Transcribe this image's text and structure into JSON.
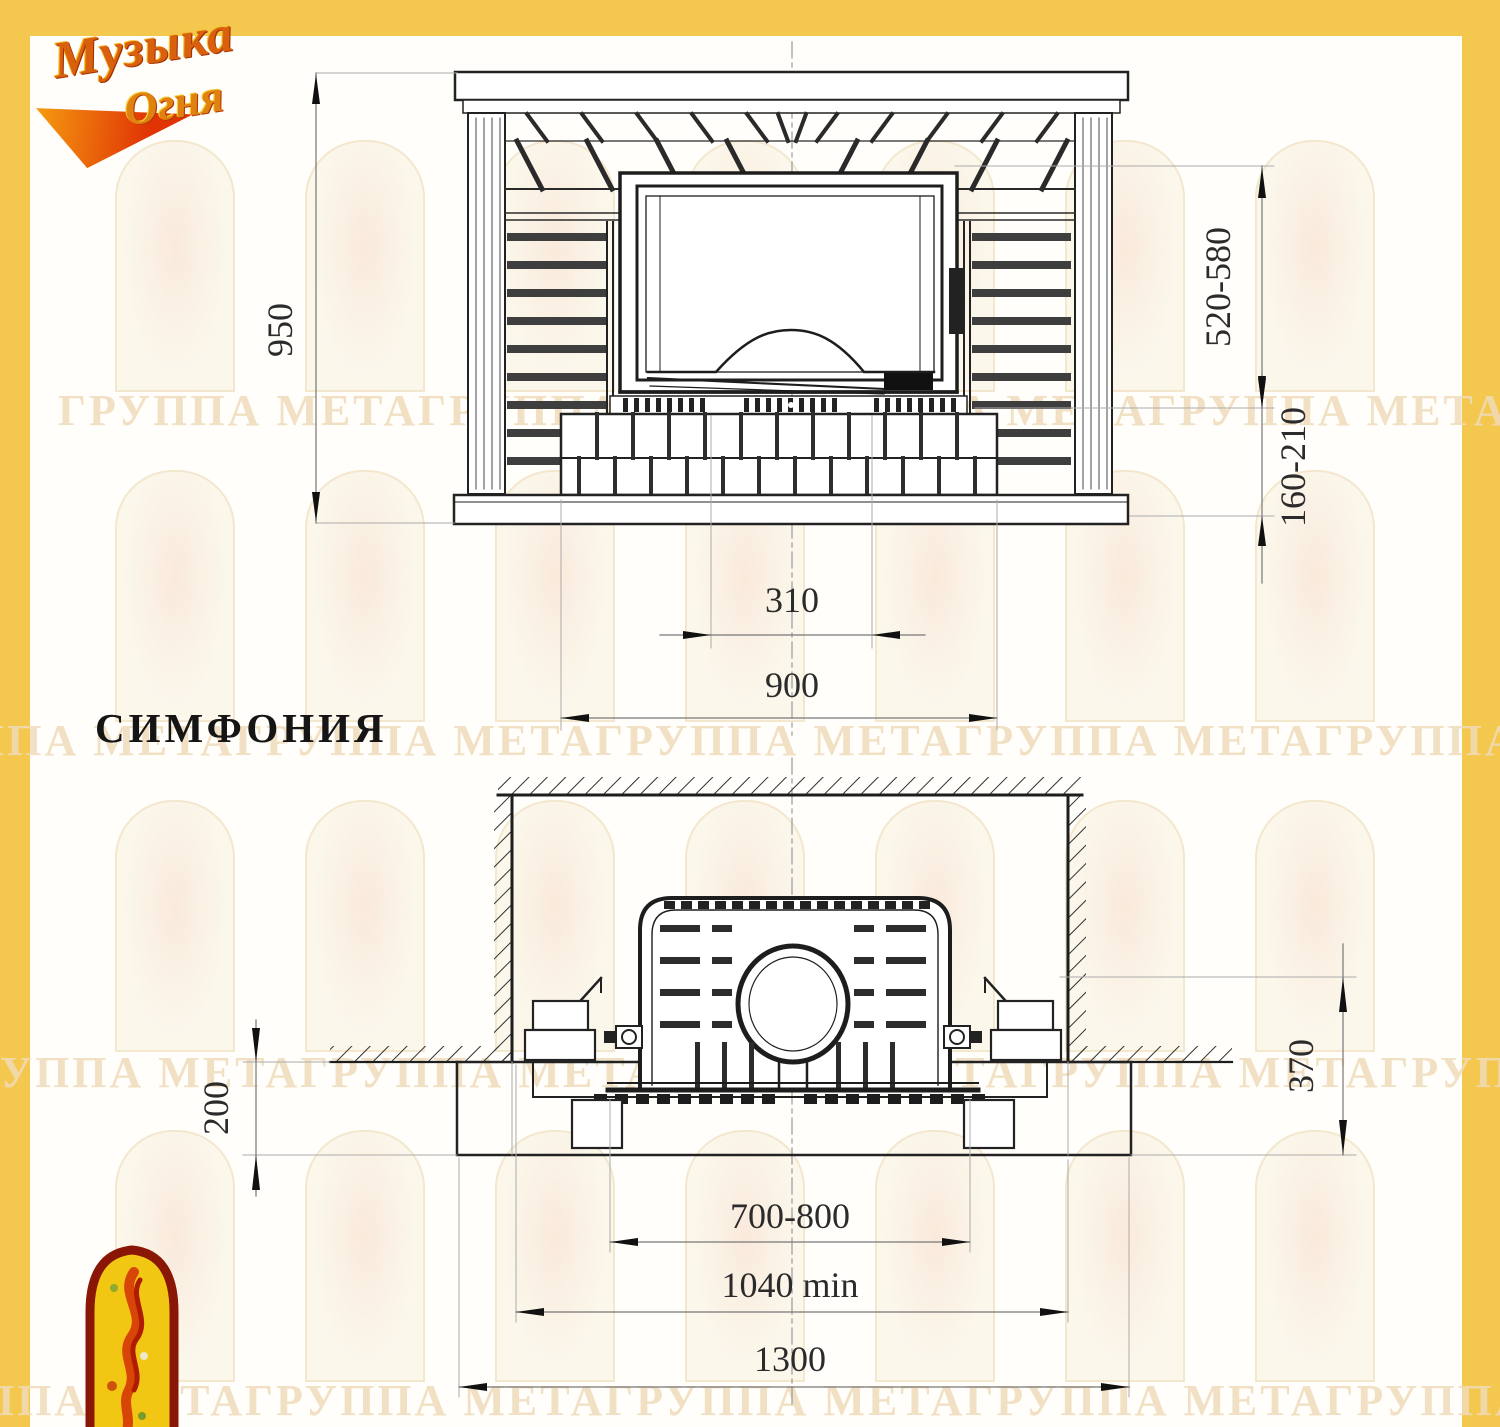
{
  "page": {
    "background": "#FFFEFB",
    "frame_color": "#F4C74E"
  },
  "logo": {
    "word1": "Музыка",
    "word2": "Огня"
  },
  "title": "СИМФОНИЯ",
  "watermark": {
    "rows": [
      "ГРУППА МЕТАГРУППА МЕГА ГРУППА МЕТАГРУППА МЕТАГРУППА МЕТА",
      "ППА МЕТАГРУППА МЕТАГРУППА МЕТАГРУППА МЕТАГРУППА МЕТА",
      "ГРУППА МЕТАГРУППА МЕТАГРУППА МЕТАГРУППА МЕТАГРУППА МЕТА",
      "ППА МЕТАГРУППА МЕТАГРУППА МЕТАГРУППА МЕТАГРУППА МЕТА"
    ]
  },
  "front_view": {
    "dims": {
      "overall_height": "950",
      "firebox_top_range": "520-580",
      "hearth_range": "160-210",
      "center_width": "310",
      "base_width": "900"
    }
  },
  "plan_view": {
    "dims": {
      "floor_offset": "200",
      "slab_offset": "370",
      "opening_range": "700-800",
      "niche_min": "1040 min",
      "slab_width": "1300"
    }
  }
}
